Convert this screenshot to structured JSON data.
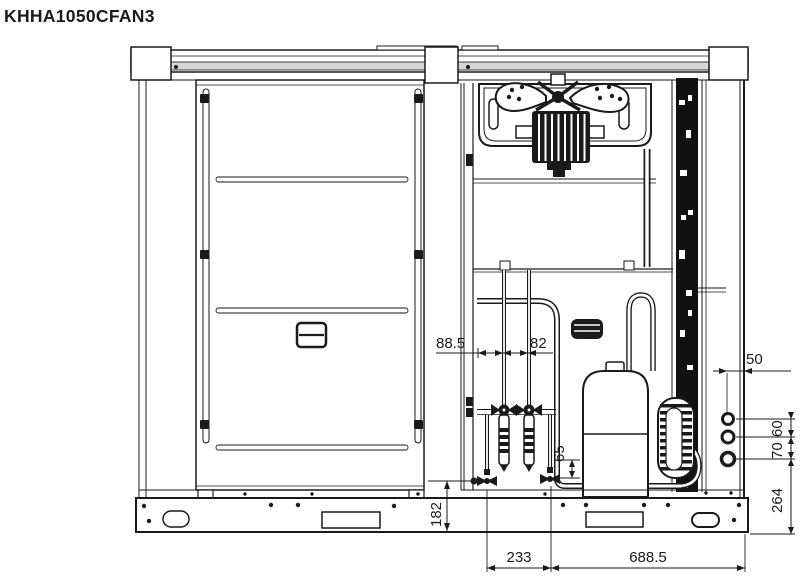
{
  "title": "KHHA1050CFAN3",
  "dimensions": {
    "valve_offset": "88.5",
    "valve_spacing": "82",
    "valve_b_height": "65",
    "valve_a_height": "182",
    "base_span_left": "233",
    "base_span_right": "688.5",
    "holes_edge_offset": "50",
    "hole_gap_top": "60",
    "hole_gap_bottom": "70",
    "holes_base_height": "264"
  },
  "colors": {
    "line": "#1a1a1a",
    "rail_fill": "#d6d6d6",
    "background": "#ffffff"
  }
}
